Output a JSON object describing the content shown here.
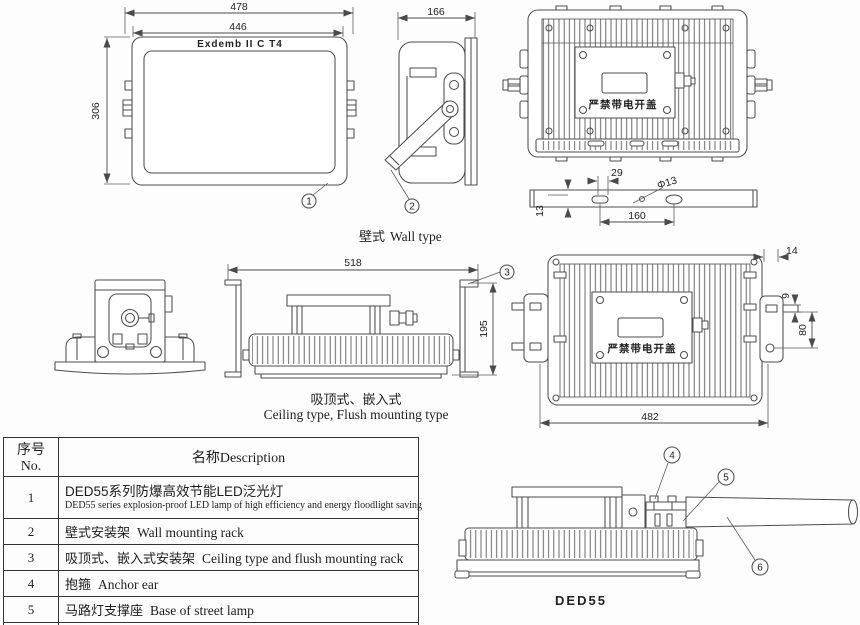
{
  "front_view": {
    "marking": "Exdemb II C T4",
    "dim_outer": "478",
    "dim_inner": "446",
    "dim_height": "306",
    "callout": "1"
  },
  "side_view": {
    "dim_depth": "166",
    "callout": "2"
  },
  "back_view_top": {
    "warning": "严禁带电开盖"
  },
  "mount_bar": {
    "dim_slot": "29",
    "dim_hole": "Φ13",
    "dim_spacing": "160",
    "dim_thickness": "13"
  },
  "wall_label": {
    "zh": "壁式",
    "en": "Wall type"
  },
  "ceiling_view": {
    "dim_width": "518",
    "dim_height": "195",
    "callout": "3"
  },
  "ceiling_label": {
    "zh": "吸顶式、嵌入式",
    "en": "Ceiling type, Flush mounting type"
  },
  "back_view_mid": {
    "warning": "严禁带电开盖",
    "dim_lug": "14",
    "dim_pin": "9",
    "dim_pin_spacing": "80",
    "dim_width": "482"
  },
  "street_view": {
    "callout_anchor": "4",
    "callout_base": "5",
    "callout_pole": "6",
    "model_label": "DED55"
  },
  "parts_table": {
    "header_no": "序号No.",
    "header_desc": "名称Description",
    "rows": [
      {
        "no": "1",
        "zh": "DED55系列防爆高效节能LED泛光灯",
        "en": "DED55 series explosion-proof LED lamp of high efficiency and energy floodlight saving"
      },
      {
        "no": "2",
        "zh": "壁式安装架",
        "en": "Wall mounting rack"
      },
      {
        "no": "3",
        "zh": "吸顶式、嵌入式安装架",
        "en": "Ceiling type and flush mounting rack"
      },
      {
        "no": "4",
        "zh": "抱箍",
        "en": "Anchor ear"
      },
      {
        "no": "5",
        "zh": "马路灯支撑座",
        "en": "Base of street lamp"
      },
      {
        "no": "6",
        "zh": "圆锥型一体式灯杆",
        "en": "Conical integrated lamppost"
      }
    ]
  },
  "colors": {
    "line": "#4d4d4d",
    "text": "#1d1d1d",
    "background": "#fdfdfd"
  }
}
